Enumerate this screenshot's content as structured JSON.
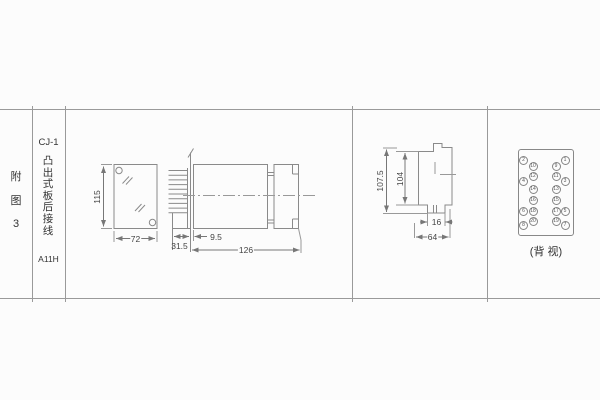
{
  "figure": {
    "index_label": "附图3",
    "model": "CJ-1",
    "mounting_desc": "凸出式板后接线",
    "code": "A11H"
  },
  "front_view": {
    "height_mm": "115",
    "width_mm": "72"
  },
  "side_view": {
    "gap_mm": "9.5",
    "projection_mm": "31.5",
    "depth_mm": "126"
  },
  "cutout_view": {
    "outer_height_mm": "107.5",
    "inner_height_mm": "104",
    "tab_width_mm": "16",
    "width_mm": "64"
  },
  "back_view": {
    "caption": "(背 视)",
    "pins": [
      "1",
      "2",
      "3",
      "4",
      "5",
      "6",
      "7",
      "8",
      "9",
      "10",
      "11",
      "12",
      "13",
      "14",
      "15",
      "16",
      "17",
      "18",
      "19",
      "20"
    ]
  }
}
